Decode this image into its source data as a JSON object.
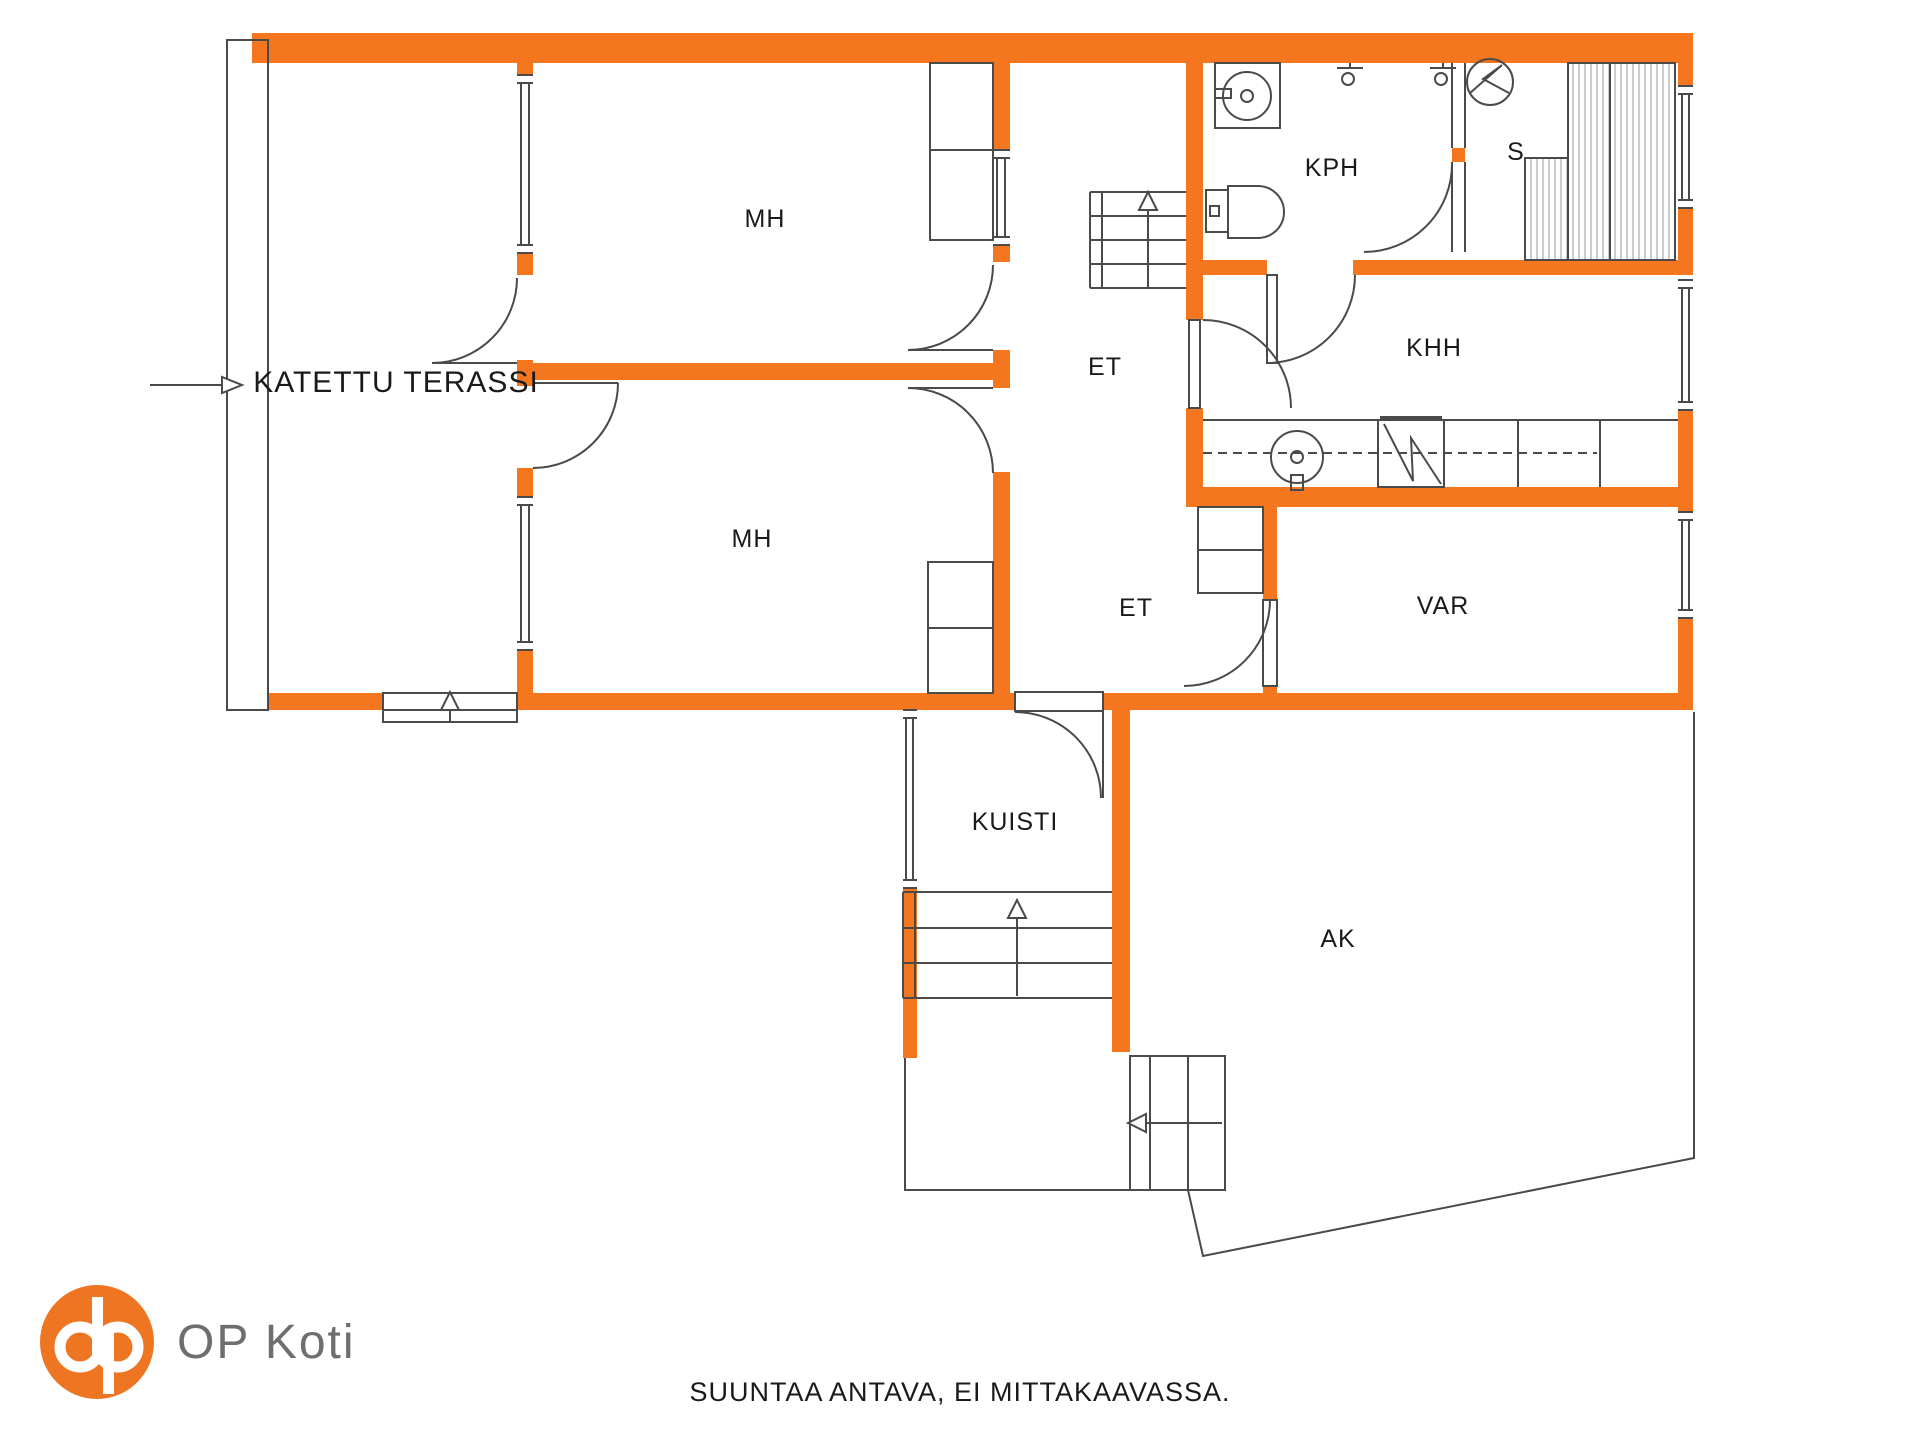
{
  "title": "Floor plan",
  "colors": {
    "wall_orange": "#F4771F",
    "logo_orange": "#EE7623",
    "line_gray": "#4A4A4A",
    "hatch_gray": "#9A9A9A",
    "label_black": "#1A1A1A",
    "brand_gray": "#6E6E6E"
  },
  "rooms": {
    "katettu_terassi": {
      "label": "KATETTU TERASSI"
    },
    "mh_top": {
      "label": "MH"
    },
    "mh_bottom": {
      "label": "MH"
    },
    "et_upper": {
      "label": "ET"
    },
    "et_lower": {
      "label": "ET"
    },
    "kph": {
      "label": "KPH"
    },
    "s": {
      "label": "S"
    },
    "khh": {
      "label": "KHH"
    },
    "var": {
      "label": "VAR"
    },
    "kuisti": {
      "label": "KUISTI"
    },
    "ak": {
      "label": "AK"
    }
  },
  "icons": [
    "sauna-stove-icon",
    "sauna-bench-icon",
    "washing-machine-icon",
    "shower-icon",
    "toilet-icon",
    "sink-icon",
    "appliance-icon",
    "stairs-up-icon",
    "stairs-exit-icon",
    "entry-arrow-icon",
    "door-swing-icon",
    "window-icon",
    "op-logo-icon"
  ],
  "footer": {
    "disclaimer": "SUUNTAA ANTAVA, EI MITTAKAAVASSA."
  },
  "brand": {
    "name": "OP Koti"
  }
}
